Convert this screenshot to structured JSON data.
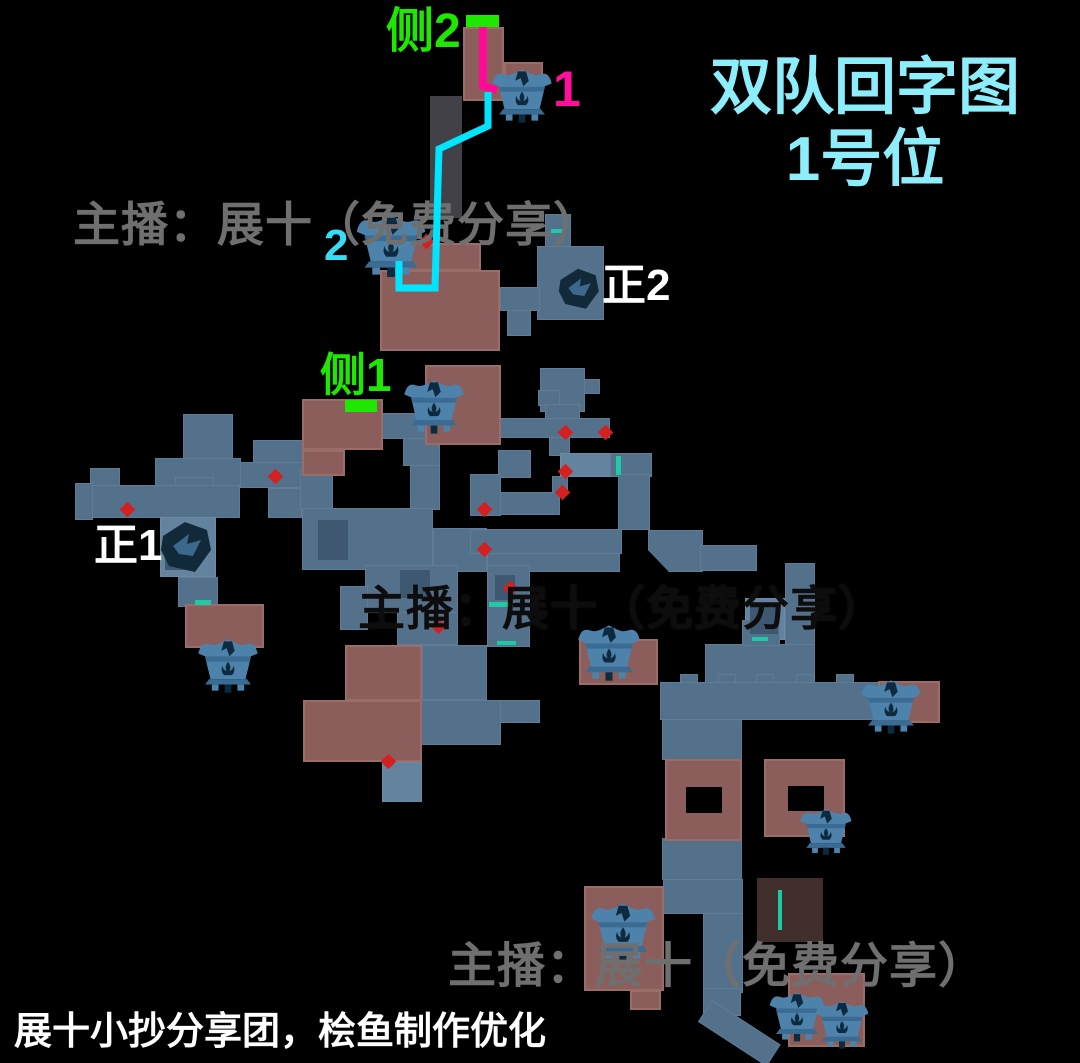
{
  "title": {
    "line1": "双队回字图",
    "line2": "1号位",
    "color": "#8deefb"
  },
  "labels": {
    "side2": {
      "text": "侧2",
      "color": "#1fe800"
    },
    "chest1": {
      "text": "1",
      "color": "#ff0f9b"
    },
    "chest2": {
      "text": "2",
      "color": "#35dcf2"
    },
    "main2": {
      "text": "正2",
      "color": "#ffffff"
    },
    "side1": {
      "text": "侧1",
      "color": "#1fe800"
    },
    "main1": {
      "text": "正1",
      "color": "#ffffff"
    }
  },
  "watermarks": {
    "top": "主播：展十（免费分享）",
    "middle": "主播：展十（免费分享）",
    "bottom": "主播：展十（免费分享）"
  },
  "credit": {
    "text": "展十小抄分享团，桧鱼制作优化"
  },
  "colors": {
    "background": "#000000",
    "corridor": "#54718c",
    "corridor_light": "#63839f",
    "corridor_dim": "#4a4850",
    "corridor_detail": "#3f5872",
    "room": "#8b5e5c",
    "room_dim": "#5c4340",
    "red_dot": "#d42020",
    "door_teal": "#1ec9a4",
    "marker_green": "#1fe800",
    "chest_blue": "#4d82ab",
    "chest_dark": "#0e2a3e",
    "title_cyan": "#8deefb",
    "watermark_gray": "#6f6f6f",
    "watermark_dark": "#0d0d0d",
    "credit_white": "#ffffff"
  },
  "map": {
    "corridors": [
      {
        "x": 430,
        "y": 96,
        "w": 32,
        "h": 122,
        "cls": "dim"
      },
      {
        "x": 545,
        "y": 214,
        "w": 26,
        "h": 34
      },
      {
        "x": 537,
        "y": 246,
        "w": 67,
        "h": 74
      },
      {
        "x": 519,
        "y": 289,
        "w": 18,
        "h": 21
      },
      {
        "x": 500,
        "y": 287,
        "w": 40,
        "h": 24
      },
      {
        "x": 507,
        "y": 310,
        "w": 24,
        "h": 26
      },
      {
        "x": 540,
        "y": 368,
        "w": 45,
        "h": 44
      },
      {
        "x": 584,
        "y": 379,
        "w": 16,
        "h": 15
      },
      {
        "x": 377,
        "y": 413,
        "w": 62,
        "h": 26
      },
      {
        "x": 403,
        "y": 438,
        "w": 37,
        "h": 28
      },
      {
        "x": 410,
        "y": 465,
        "w": 30,
        "h": 45
      },
      {
        "x": 253,
        "y": 440,
        "w": 51,
        "h": 29
      },
      {
        "x": 240,
        "y": 462,
        "w": 63,
        "h": 26
      },
      {
        "x": 268,
        "y": 488,
        "w": 34,
        "h": 30
      },
      {
        "x": 183,
        "y": 414,
        "w": 50,
        "h": 46
      },
      {
        "x": 155,
        "y": 458,
        "w": 86,
        "h": 28
      },
      {
        "x": 90,
        "y": 468,
        "w": 30,
        "h": 18
      },
      {
        "x": 175,
        "y": 477,
        "w": 39,
        "h": 42
      },
      {
        "x": 75,
        "y": 483,
        "w": 18,
        "h": 37
      },
      {
        "x": 92,
        "y": 485,
        "w": 148,
        "h": 33
      },
      {
        "x": 160,
        "y": 517,
        "w": 56,
        "h": 60,
        "cls": "cl"
      },
      {
        "x": 178,
        "y": 577,
        "w": 40,
        "h": 30
      },
      {
        "x": 300,
        "y": 470,
        "w": 33,
        "h": 40
      },
      {
        "x": 302,
        "y": 508,
        "w": 131,
        "h": 62
      },
      {
        "x": 433,
        "y": 528,
        "w": 54,
        "h": 44
      },
      {
        "x": 538,
        "y": 390,
        "w": 22,
        "h": 16
      },
      {
        "x": 545,
        "y": 404,
        "w": 35,
        "h": 16
      },
      {
        "x": 470,
        "y": 418,
        "w": 140,
        "h": 20
      },
      {
        "x": 549,
        "y": 437,
        "w": 21,
        "h": 19
      },
      {
        "x": 498,
        "y": 450,
        "w": 33,
        "h": 28
      },
      {
        "x": 560,
        "y": 453,
        "w": 58,
        "h": 24,
        "cls": "cl"
      },
      {
        "x": 610,
        "y": 453,
        "w": 42,
        "h": 24
      },
      {
        "x": 552,
        "y": 476,
        "w": 16,
        "h": 18
      },
      {
        "x": 470,
        "y": 474,
        "w": 31,
        "h": 42
      },
      {
        "x": 500,
        "y": 492,
        "w": 60,
        "h": 23
      },
      {
        "x": 470,
        "y": 529,
        "w": 152,
        "h": 25
      },
      {
        "x": 618,
        "y": 474,
        "w": 32,
        "h": 56
      },
      {
        "x": 648,
        "y": 530,
        "w": 55,
        "h": 42,
        "cls": "diag"
      },
      {
        "x": 700,
        "y": 545,
        "w": 57,
        "h": 26
      },
      {
        "x": 487,
        "y": 553,
        "w": 133,
        "h": 19
      },
      {
        "x": 365,
        "y": 565,
        "w": 93,
        "h": 48
      },
      {
        "x": 340,
        "y": 586,
        "w": 28,
        "h": 44
      },
      {
        "x": 397,
        "y": 612,
        "w": 61,
        "h": 33
      },
      {
        "x": 487,
        "y": 565,
        "w": 43,
        "h": 82
      },
      {
        "x": 422,
        "y": 645,
        "w": 65,
        "h": 55
      },
      {
        "x": 421,
        "y": 700,
        "w": 80,
        "h": 45
      },
      {
        "x": 500,
        "y": 700,
        "w": 40,
        "h": 23
      },
      {
        "x": 382,
        "y": 762,
        "w": 40,
        "h": 40,
        "cls": "cl"
      },
      {
        "x": 785,
        "y": 563,
        "w": 30,
        "h": 92
      },
      {
        "x": 745,
        "y": 598,
        "w": 40,
        "h": 42,
        "cls": "cl"
      },
      {
        "x": 705,
        "y": 644,
        "w": 110,
        "h": 40
      },
      {
        "x": 742,
        "y": 620,
        "w": 38,
        "h": 26
      },
      {
        "x": 660,
        "y": 682,
        "w": 280,
        "h": 38
      },
      {
        "x": 680,
        "y": 674,
        "w": 18,
        "h": 9
      },
      {
        "x": 718,
        "y": 674,
        "w": 18,
        "h": 9
      },
      {
        "x": 756,
        "y": 674,
        "w": 18,
        "h": 9
      },
      {
        "x": 796,
        "y": 674,
        "w": 18,
        "h": 9
      },
      {
        "x": 836,
        "y": 674,
        "w": 18,
        "h": 9
      },
      {
        "x": 662,
        "y": 719,
        "w": 80,
        "h": 41
      },
      {
        "x": 662,
        "y": 838,
        "w": 80,
        "h": 42
      },
      {
        "x": 663,
        "y": 879,
        "w": 80,
        "h": 35
      },
      {
        "x": 703,
        "y": 913,
        "w": 40,
        "h": 80
      },
      {
        "x": 703,
        "y": 988,
        "w": 38,
        "h": 28
      },
      {
        "x": 712,
        "y": 1000,
        "w": 82,
        "h": 26,
        "cls": "rot"
      },
      {
        "x": 318,
        "y": 520,
        "w": 30,
        "h": 40,
        "cls": "d"
      },
      {
        "x": 400,
        "y": 570,
        "w": 30,
        "h": 28,
        "cls": "d"
      },
      {
        "x": 750,
        "y": 604,
        "w": 28,
        "h": 30,
        "cls": "d"
      },
      {
        "x": 165,
        "y": 545,
        "w": 25,
        "h": 25,
        "cls": "d"
      },
      {
        "x": 495,
        "y": 575,
        "w": 20,
        "h": 25,
        "cls": "d"
      }
    ],
    "rooms": [
      {
        "x": 463,
        "y": 27,
        "w": 41,
        "h": 74
      },
      {
        "x": 504,
        "y": 62,
        "w": 39,
        "h": 26
      },
      {
        "x": 393,
        "y": 243,
        "w": 88,
        "h": 28
      },
      {
        "x": 380,
        "y": 270,
        "w": 120,
        "h": 81
      },
      {
        "x": 425,
        "y": 365,
        "w": 76,
        "h": 80
      },
      {
        "x": 302,
        "y": 399,
        "w": 81,
        "h": 51
      },
      {
        "x": 302,
        "y": 450,
        "w": 43,
        "h": 26
      },
      {
        "x": 185,
        "y": 604,
        "w": 79,
        "h": 44
      },
      {
        "x": 345,
        "y": 645,
        "w": 77,
        "h": 56
      },
      {
        "x": 303,
        "y": 700,
        "w": 119,
        "h": 62
      },
      {
        "x": 878,
        "y": 681,
        "w": 62,
        "h": 42
      },
      {
        "x": 579,
        "y": 639,
        "w": 79,
        "h": 46
      },
      {
        "x": 665,
        "y": 759,
        "w": 77,
        "h": 82
      },
      {
        "x": 764,
        "y": 759,
        "w": 81,
        "h": 78
      },
      {
        "x": 584,
        "y": 886,
        "w": 80,
        "h": 105
      },
      {
        "x": 630,
        "y": 990,
        "w": 31,
        "h": 20
      },
      {
        "x": 788,
        "y": 973,
        "w": 77,
        "h": 74
      },
      {
        "x": 757,
        "y": 878,
        "w": 66,
        "h": 64,
        "cls": "rdim"
      }
    ],
    "holes": [
      {
        "x": 686,
        "y": 787,
        "w": 36,
        "h": 26
      },
      {
        "x": 788,
        "y": 786,
        "w": 36,
        "h": 25
      }
    ],
    "red_dots": [
      {
        "x": 421,
        "y": 236
      },
      {
        "x": 270,
        "y": 471
      },
      {
        "x": 122,
        "y": 504
      },
      {
        "x": 560,
        "y": 427
      },
      {
        "x": 600,
        "y": 427
      },
      {
        "x": 560,
        "y": 466
      },
      {
        "x": 557,
        "y": 487
      },
      {
        "x": 479,
        "y": 504
      },
      {
        "x": 479,
        "y": 544
      },
      {
        "x": 505,
        "y": 583
      },
      {
        "x": 433,
        "y": 621
      },
      {
        "x": 383,
        "y": 756
      }
    ],
    "doors": [
      {
        "x": 551,
        "y": 229,
        "w": 15,
        "h": 4
      },
      {
        "x": 195,
        "y": 600,
        "w": 16,
        "h": 5
      },
      {
        "x": 616,
        "y": 456,
        "w": 5,
        "h": 19
      },
      {
        "x": 489,
        "y": 602,
        "w": 26,
        "h": 5
      },
      {
        "x": 497,
        "y": 641,
        "w": 19,
        "h": 4
      },
      {
        "x": 752,
        "y": 637,
        "w": 16,
        "h": 4
      },
      {
        "x": 778,
        "y": 890,
        "w": 4,
        "h": 40
      }
    ],
    "markers": [
      {
        "x": 466,
        "y": 15,
        "w": 33,
        "h": 12,
        "name": "side2-start-marker"
      },
      {
        "x": 345,
        "y": 400,
        "w": 32,
        "h": 12,
        "name": "side1-start-marker"
      }
    ],
    "chests": [
      {
        "x": 487,
        "y": 66,
        "w": 70,
        "h": 58,
        "name": "treasure-chest-1"
      },
      {
        "x": 352,
        "y": 210,
        "w": 78,
        "h": 70,
        "name": "treasure-chest-2"
      },
      {
        "x": 400,
        "y": 377,
        "w": 68,
        "h": 58,
        "name": "treasure-chest-side1"
      },
      {
        "x": 192,
        "y": 636,
        "w": 72,
        "h": 58,
        "name": "treasure-chest-west"
      },
      {
        "x": 574,
        "y": 621,
        "w": 70,
        "h": 62,
        "name": "treasure-chest-center"
      },
      {
        "x": 850,
        "y": 677,
        "w": 82,
        "h": 58,
        "name": "treasure-chest-east"
      },
      {
        "x": 797,
        "y": 806,
        "w": 58,
        "h": 50,
        "name": "treasure-chest-courtyard"
      },
      {
        "x": 586,
        "y": 900,
        "w": 74,
        "h": 62,
        "name": "treasure-chest-south"
      },
      {
        "x": 766,
        "y": 988,
        "w": 62,
        "h": 56,
        "name": "treasure-chest-southeast-1"
      },
      {
        "x": 812,
        "y": 998,
        "w": 60,
        "h": 52,
        "name": "treasure-chest-southeast-2"
      }
    ],
    "spawns": [
      {
        "x": 553,
        "y": 264,
        "w": 50,
        "h": 48,
        "name": "spawn-icon-main2"
      },
      {
        "x": 155,
        "y": 515,
        "w": 60,
        "h": 62,
        "name": "spawn-icon-main1"
      }
    ]
  },
  "routes": [
    {
      "name": "route-magenta",
      "color": "#ff0a96",
      "width": 8,
      "points": "483,18 483,86 497,90"
    },
    {
      "name": "route-cyan",
      "color": "#00e5ff",
      "width": 7,
      "points": "488,92 488,126 439,149 435,288 399,288 399,261"
    }
  ]
}
